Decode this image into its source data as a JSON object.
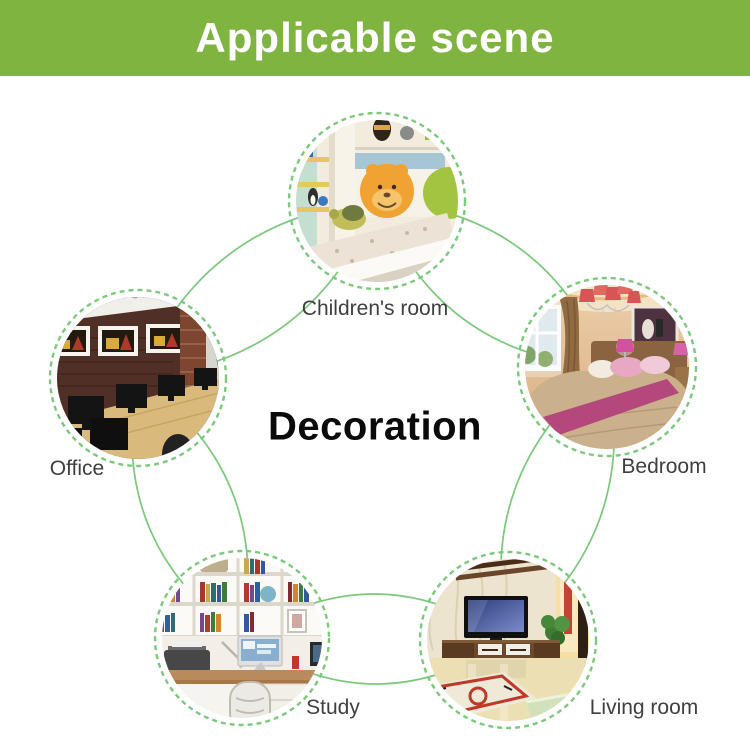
{
  "header": {
    "title": "Applicable scene",
    "bg_color": "#7FB440",
    "text_color": "#FFFFFF"
  },
  "diagram": {
    "center_label": "Decoration",
    "line_color": "#7CC87C",
    "scenes": [
      {
        "id": "children-room",
        "label": "Children's room"
      },
      {
        "id": "bedroom",
        "label": "Bedroom"
      },
      {
        "id": "living-room",
        "label": "Living room"
      },
      {
        "id": "study",
        "label": "Study"
      },
      {
        "id": "office",
        "label": "Office"
      }
    ]
  }
}
